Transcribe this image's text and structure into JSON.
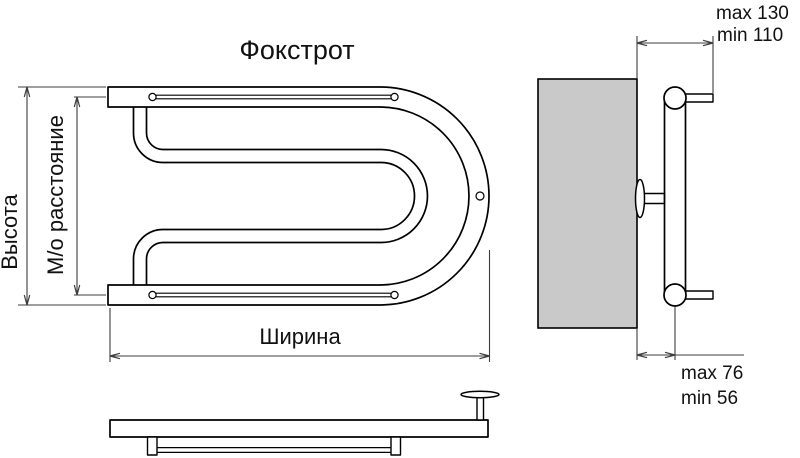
{
  "title": "Фокстрот",
  "front_view": {
    "height_label": "Высота",
    "axis_distance_label": "М/о расстояние",
    "width_label": "Ширина"
  },
  "side_view": {
    "top_offset_max": "max 130",
    "top_offset_min": "min 110",
    "bottom_offset_max": "max 76",
    "bottom_offset_min": "min 56"
  },
  "colors": {
    "object_line": "#000000",
    "dimension_line": "#3d3d3d",
    "wall_fill": "#c9c9c9",
    "background": "#ffffff"
  }
}
